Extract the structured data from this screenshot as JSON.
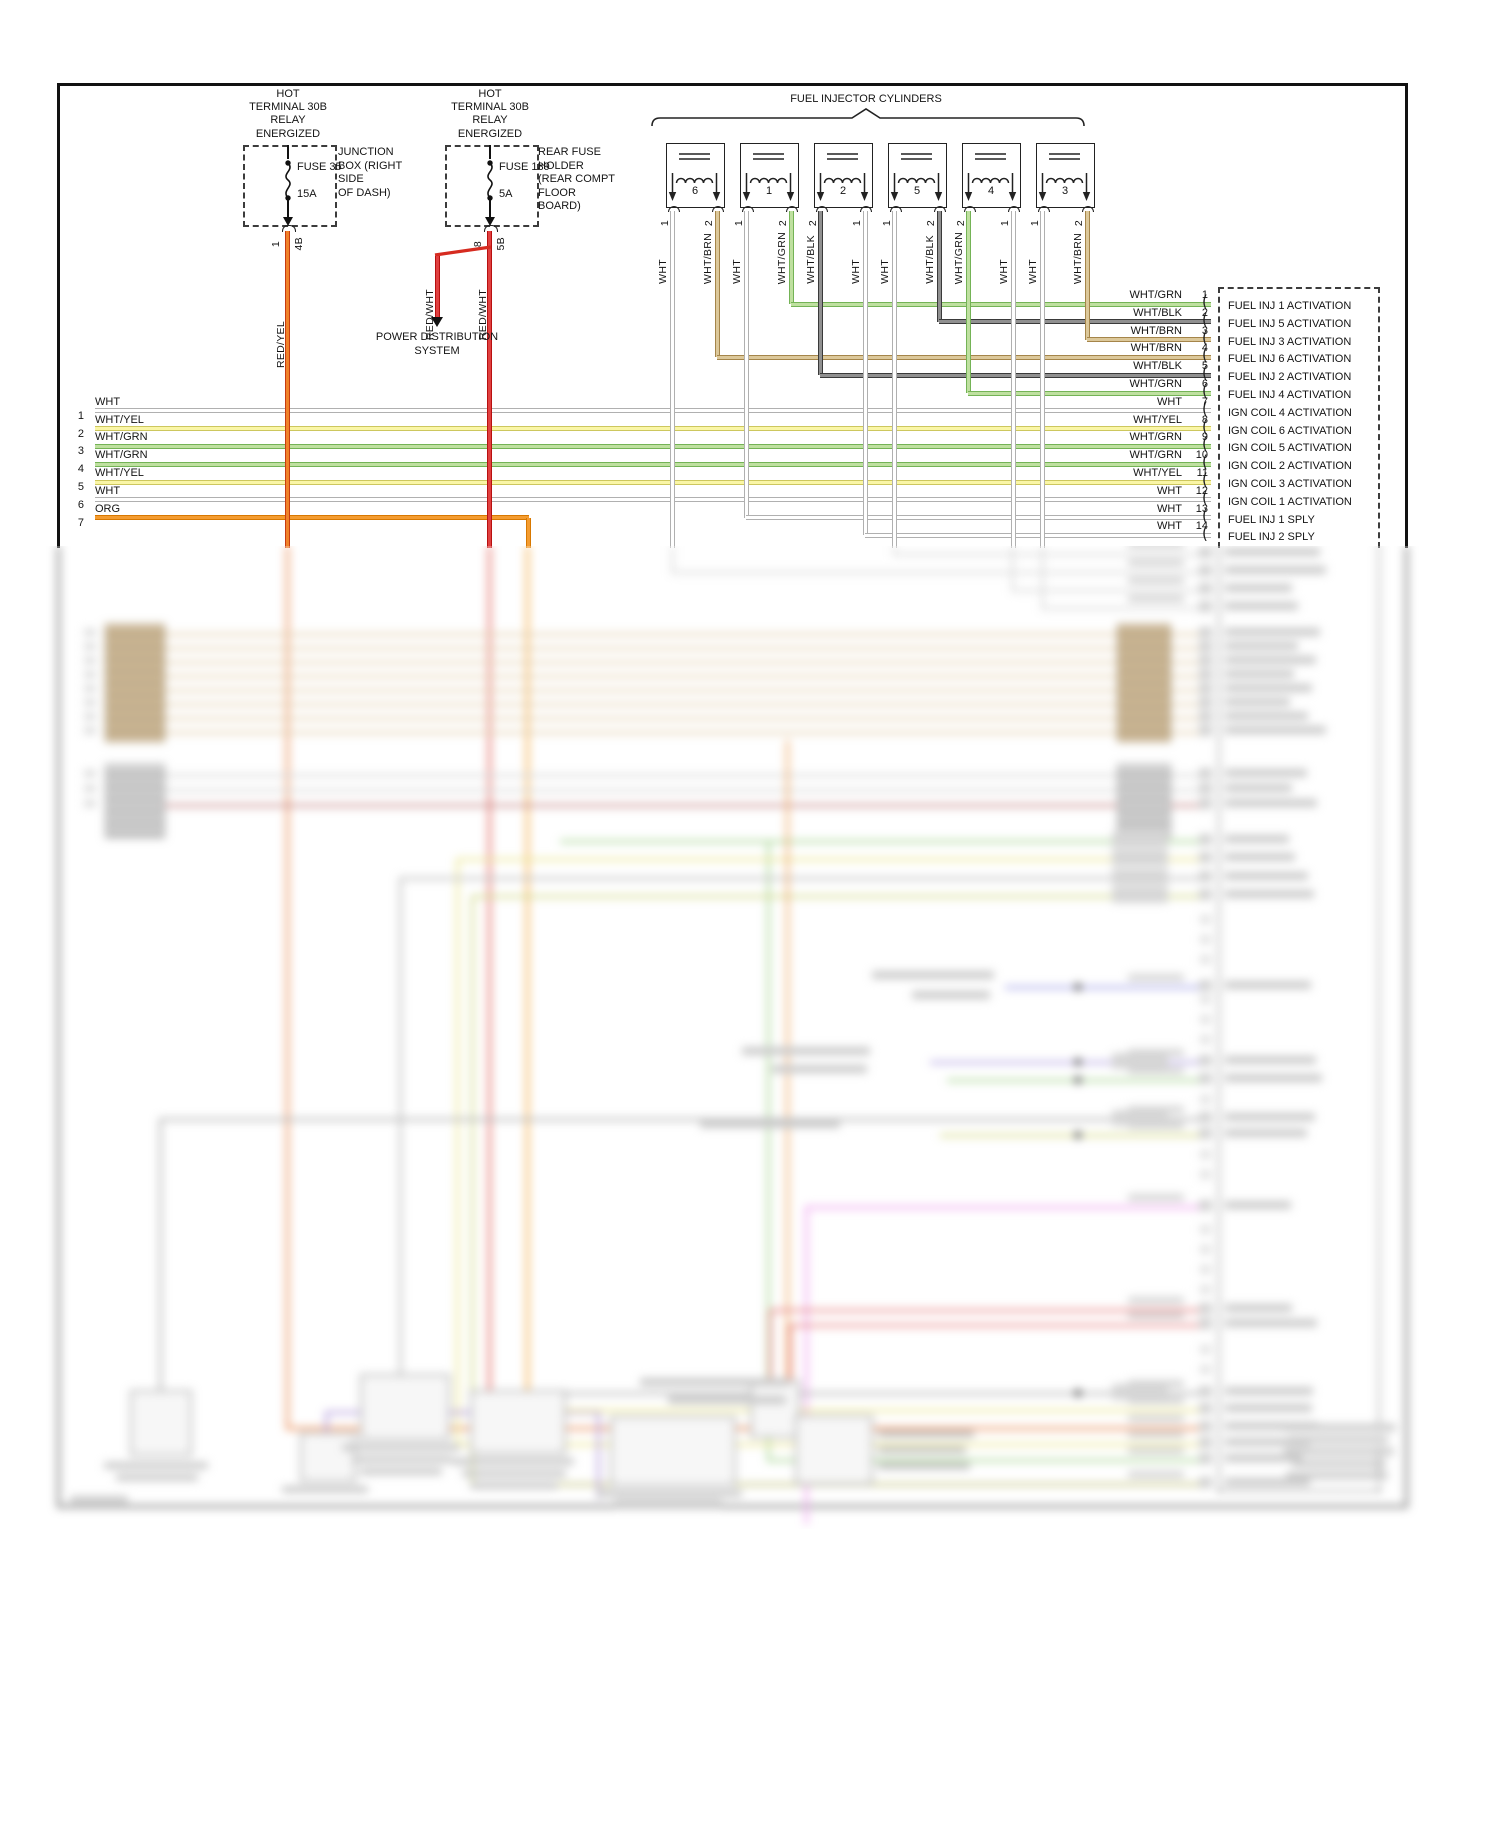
{
  "injectors": {
    "title": "FUEL INJECTOR CYLINDERS",
    "items": [
      {
        "cyl": "6",
        "pins": [
          "1",
          "2"
        ],
        "colors": [
          "WHT",
          "WHT/BRN"
        ]
      },
      {
        "cyl": "1",
        "pins": [
          "1",
          "2"
        ],
        "colors": [
          "WHT",
          "WHT/GRN"
        ]
      },
      {
        "cyl": "2",
        "pins": [
          "2",
          "1"
        ],
        "colors": [
          "WHT/BLK",
          "WHT"
        ]
      },
      {
        "cyl": "5",
        "pins": [
          "1",
          "2"
        ],
        "colors": [
          "WHT",
          "WHT/BLK"
        ]
      },
      {
        "cyl": "4",
        "pins": [
          "2",
          "1"
        ],
        "colors": [
          "WHT/GRN",
          "WHT"
        ]
      },
      {
        "cyl": "3",
        "pins": [
          "1",
          "2"
        ],
        "colors": [
          "WHT",
          "WHT/BRN"
        ]
      }
    ]
  },
  "fuse_boxes": [
    {
      "hot_lines": [
        "HOT",
        "TERMINAL 30B",
        "RELAY",
        "ENERGIZED"
      ],
      "fuse_name": "FUSE 35",
      "amp": "15A",
      "pin_in": "1",
      "pin_out": "4B",
      "wire_color": "RED/YEL",
      "note_lines": [
        "JUNCTION",
        "BOX (RIGHT",
        "SIDE",
        "OF DASH)"
      ]
    },
    {
      "hot_lines": [
        "HOT",
        "TERMINAL 30B",
        "RELAY",
        "ENERGIZED"
      ],
      "fuse_name": "FUSE 139",
      "amp": "5A",
      "pin_in": "8",
      "pin_out": "5B",
      "wire_color": "RED/WHT",
      "note_lines": [
        "REAR FUSE",
        "HOLDER",
        "(REAR COMPT",
        "FLOOR",
        "BOARD)"
      ]
    }
  ],
  "power_distribution": {
    "lines": [
      "POWER DISTRIBUTION",
      "SYSTEM"
    ],
    "wire_color": "RED/WHT"
  },
  "left_rows": [
    {
      "n": "1",
      "color": "WHT"
    },
    {
      "n": "2",
      "color": "WHT/YEL"
    },
    {
      "n": "3",
      "color": "WHT/GRN"
    },
    {
      "n": "4",
      "color": "WHT/GRN"
    },
    {
      "n": "5",
      "color": "WHT/YEL"
    },
    {
      "n": "6",
      "color": "WHT"
    },
    {
      "n": "7",
      "color": "ORG"
    }
  ],
  "ecm_pins": [
    {
      "n": "1",
      "color": "WHT/GRN",
      "label": "FUEL INJ 1 ACTIVATION"
    },
    {
      "n": "2",
      "color": "WHT/BLK",
      "label": "FUEL INJ 5 ACTIVATION"
    },
    {
      "n": "3",
      "color": "WHT/BRN",
      "label": "FUEL INJ 3 ACTIVATION"
    },
    {
      "n": "4",
      "color": "WHT/BRN",
      "label": "FUEL INJ 6 ACTIVATION"
    },
    {
      "n": "5",
      "color": "WHT/BLK",
      "label": "FUEL INJ 2 ACTIVATION"
    },
    {
      "n": "6",
      "color": "WHT/GRN",
      "label": "FUEL INJ 4 ACTIVATION"
    },
    {
      "n": "7",
      "color": "WHT",
      "label": "IGN COIL 4 ACTIVATION"
    },
    {
      "n": "8",
      "color": "WHT/YEL",
      "label": "IGN COIL 6 ACTIVATION"
    },
    {
      "n": "9",
      "color": "WHT/GRN",
      "label": "IGN COIL 5 ACTIVATION"
    },
    {
      "n": "10",
      "color": "WHT/GRN",
      "label": "IGN COIL 2 ACTIVATION"
    },
    {
      "n": "11",
      "color": "WHT/YEL",
      "label": "IGN COIL 3 ACTIVATION"
    },
    {
      "n": "12",
      "color": "WHT",
      "label": "IGN COIL 1 ACTIVATION"
    },
    {
      "n": "13",
      "color": "WHT",
      "label": "FUEL INJ 1 SPLY"
    },
    {
      "n": "14",
      "color": "WHT",
      "label": "FUEL INJ 2 SPLY"
    }
  ],
  "wire_colors": {
    "WHT": {
      "fill": "#ffffff",
      "edge": "#b0b0b0"
    },
    "WHT/YEL": {
      "fill": "#faf6a6",
      "edge": "#cdc75e"
    },
    "WHT/GRN": {
      "fill": "#bfe0a0",
      "edge": "#74b356"
    },
    "WHT/BLK": {
      "fill": "#909090",
      "edge": "#3a3a3a"
    },
    "WHT/BRN": {
      "fill": "#dcc89a",
      "edge": "#a5854a"
    },
    "RED/YEL": {
      "fill": "#f0822a",
      "edge": "#c83c10"
    },
    "RED/WHT": {
      "fill": "#e04040",
      "edge": "#b81010"
    },
    "ORG": {
      "fill": "#f49c30",
      "edge": "#d87800"
    }
  }
}
